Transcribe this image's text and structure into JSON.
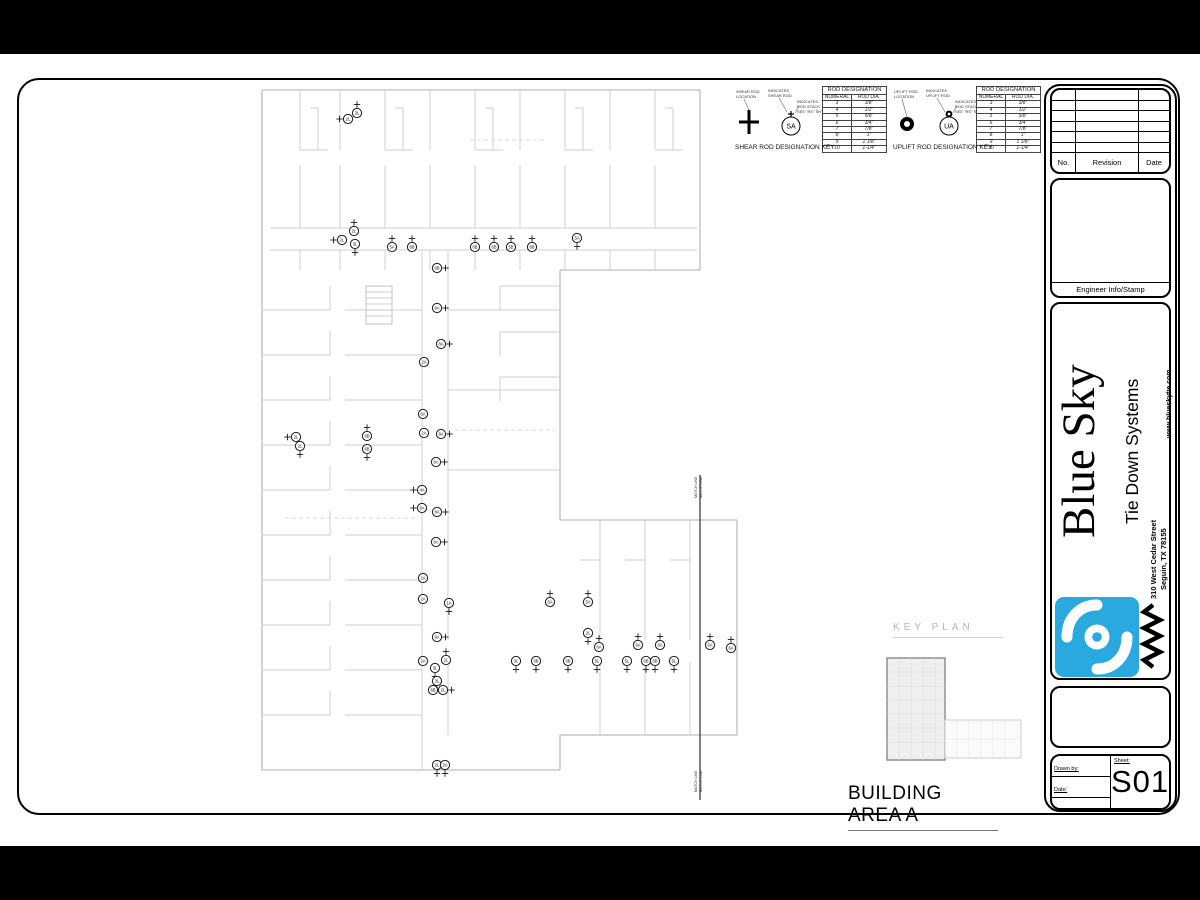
{
  "plan": {
    "area_label": "BUILDING AREA A",
    "markers": [
      {
        "x": 348,
        "y": 119,
        "l": "2L",
        "c": "l"
      },
      {
        "x": 357,
        "y": 113,
        "l": "3L",
        "c": "u"
      },
      {
        "x": 342,
        "y": 240,
        "l": "2L",
        "c": "l"
      },
      {
        "x": 354,
        "y": 231,
        "l": "2L",
        "c": "u"
      },
      {
        "x": 355,
        "y": 244,
        "l": "3L",
        "c": "d"
      },
      {
        "x": 392,
        "y": 247,
        "l": "5A",
        "c": "u"
      },
      {
        "x": 412,
        "y": 247,
        "l": "6B",
        "c": "u"
      },
      {
        "x": 475,
        "y": 247,
        "l": "6B",
        "c": "u"
      },
      {
        "x": 494,
        "y": 247,
        "l": "6B",
        "c": "u"
      },
      {
        "x": 511,
        "y": 247,
        "l": "5B",
        "c": "u"
      },
      {
        "x": 532,
        "y": 247,
        "l": "6B",
        "c": "u"
      },
      {
        "x": 577,
        "y": 238,
        "l": "5A",
        "c": "d"
      },
      {
        "x": 437,
        "y": 268,
        "l": "6B",
        "c": "r"
      },
      {
        "x": 437,
        "y": 308,
        "l": "6A",
        "c": "r"
      },
      {
        "x": 441,
        "y": 344,
        "l": "8A",
        "c": "r"
      },
      {
        "x": 424,
        "y": 362,
        "l": "2A",
        "c": ""
      },
      {
        "x": 423,
        "y": 414,
        "l": "6A",
        "c": ""
      },
      {
        "x": 424,
        "y": 433,
        "l": "2A",
        "c": ""
      },
      {
        "x": 441,
        "y": 434,
        "l": "8A",
        "c": "r"
      },
      {
        "x": 436,
        "y": 462,
        "l": "6A",
        "c": "r"
      },
      {
        "x": 422,
        "y": 490,
        "l": "4A",
        "c": "l"
      },
      {
        "x": 422,
        "y": 508,
        "l": "6A",
        "c": "l"
      },
      {
        "x": 437,
        "y": 512,
        "l": "8A",
        "c": "r"
      },
      {
        "x": 436,
        "y": 542,
        "l": "6A",
        "c": "r"
      },
      {
        "x": 423,
        "y": 578,
        "l": "2A",
        "c": ""
      },
      {
        "x": 423,
        "y": 599,
        "l": "2A",
        "c": ""
      },
      {
        "x": 449,
        "y": 603,
        "l": "1A",
        "c": "d"
      },
      {
        "x": 437,
        "y": 637,
        "l": "6A",
        "c": "r"
      },
      {
        "x": 423,
        "y": 661,
        "l": "2A",
        "c": ""
      },
      {
        "x": 446,
        "y": 660,
        "l": "2L",
        "c": "u"
      },
      {
        "x": 435,
        "y": 668,
        "l": "3L",
        "c": "d"
      },
      {
        "x": 437,
        "y": 681,
        "l": "3L",
        "c": "d"
      },
      {
        "x": 433,
        "y": 690,
        "l": "6B",
        "c": "r"
      },
      {
        "x": 443,
        "y": 690,
        "l": "2L",
        "c": "r"
      },
      {
        "x": 437,
        "y": 765,
        "l": "2L",
        "c": "d"
      },
      {
        "x": 445,
        "y": 765,
        "l": "2A",
        "c": "d"
      },
      {
        "x": 296,
        "y": 437,
        "l": "2L",
        "c": "l"
      },
      {
        "x": 300,
        "y": 446,
        "l": "2L",
        "c": "d"
      },
      {
        "x": 367,
        "y": 436,
        "l": "6B",
        "c": "u"
      },
      {
        "x": 367,
        "y": 449,
        "l": "6B",
        "c": "d"
      },
      {
        "x": 550,
        "y": 602,
        "l": "6A",
        "c": "u"
      },
      {
        "x": 588,
        "y": 602,
        "l": "5A",
        "c": "u"
      },
      {
        "x": 588,
        "y": 633,
        "l": "2L",
        "c": "d"
      },
      {
        "x": 599,
        "y": 647,
        "l": "6A",
        "c": "u"
      },
      {
        "x": 638,
        "y": 645,
        "l": "6A",
        "c": "u"
      },
      {
        "x": 660,
        "y": 645,
        "l": "6A",
        "c": "u"
      },
      {
        "x": 710,
        "y": 645,
        "l": "6A",
        "c": "u"
      },
      {
        "x": 731,
        "y": 648,
        "l": "6A",
        "c": "u"
      },
      {
        "x": 516,
        "y": 661,
        "l": "3L",
        "c": "d"
      },
      {
        "x": 536,
        "y": 661,
        "l": "6B",
        "c": "d"
      },
      {
        "x": 568,
        "y": 661,
        "l": "6B",
        "c": "d"
      },
      {
        "x": 597,
        "y": 661,
        "l": "5L",
        "c": "d"
      },
      {
        "x": 627,
        "y": 661,
        "l": "5L",
        "c": "d"
      },
      {
        "x": 646,
        "y": 661,
        "l": "6B",
        "c": "d"
      },
      {
        "x": 655,
        "y": 661,
        "l": "6B",
        "c": "d"
      },
      {
        "x": 674,
        "y": 661,
        "l": "5L",
        "c": "d"
      }
    ]
  },
  "key_plan": {
    "label": "KEY PLAN"
  },
  "match_line": {
    "label": "MATCH LINE"
  },
  "shear_key": {
    "title": "SHEAR ROD DESIGNATION KEY",
    "badge": "SA",
    "callout_location": [
      "SHEAR ROD",
      "LOCATION"
    ],
    "callout_indicates": [
      "INDICATES",
      "SHEAR ROD"
    ],
    "callout_stack": [
      "INDICATES",
      "ROD STACK",
      "SEE \"RS\" SHT."
    ],
    "table": {
      "title": "ROD DESIGNATION",
      "columns": [
        "NUMERAL",
        "ROD DIA."
      ],
      "rows": [
        [
          "3",
          "3/8\""
        ],
        [
          "4",
          "1/2\""
        ],
        [
          "5",
          "5/8\""
        ],
        [
          "6",
          "3/4\""
        ],
        [
          "7",
          "7/8\""
        ],
        [
          "8",
          "1\""
        ],
        [
          "9",
          "1 1/8\""
        ],
        [
          "10",
          "1-1/4\""
        ]
      ]
    }
  },
  "uplift_key": {
    "title": "UPLIFT ROD DESIGNATION KEY",
    "badge": "UA",
    "callout_location": [
      "UPLIFT ROD",
      "LOCATION"
    ],
    "callout_indicates": [
      "INDICATES",
      "UPLIFT ROD"
    ],
    "callout_stack": [
      "INDICATES",
      "ROD STACK",
      "SEE \"RS\" SHT."
    ],
    "table": {
      "title": "ROD DESIGNATION",
      "columns": [
        "NUMERAL",
        "ROD DIA."
      ],
      "rows": [
        [
          "3",
          "3/8\""
        ],
        [
          "4",
          "1/2\""
        ],
        [
          "5",
          "5/8\""
        ],
        [
          "6",
          "3/4\""
        ],
        [
          "7",
          "7/8\""
        ],
        [
          "8",
          "1\""
        ],
        [
          "9",
          "1 1/8\""
        ],
        [
          "10",
          "1-1/4\""
        ]
      ]
    }
  },
  "title_block": {
    "revision": {
      "no": "No.",
      "revision": "Revision",
      "date": "Date",
      "empty_rows": 6
    },
    "engineer_stamp_label": "Engineer Info/Stamp",
    "brand": {
      "name": "Blue Sky",
      "tagline": "Tie Down Systems",
      "address1": "310 West Cedar Street",
      "address2": "Seguin, TX  78155",
      "website": "www.blueskytie.com",
      "logo_color": "#29a9e0"
    },
    "fields": {
      "drawn_by": "Drawn by:",
      "date": "Date:",
      "scale": "Scale:",
      "sheet": "Sheet:",
      "sheet_number": "S01"
    }
  }
}
